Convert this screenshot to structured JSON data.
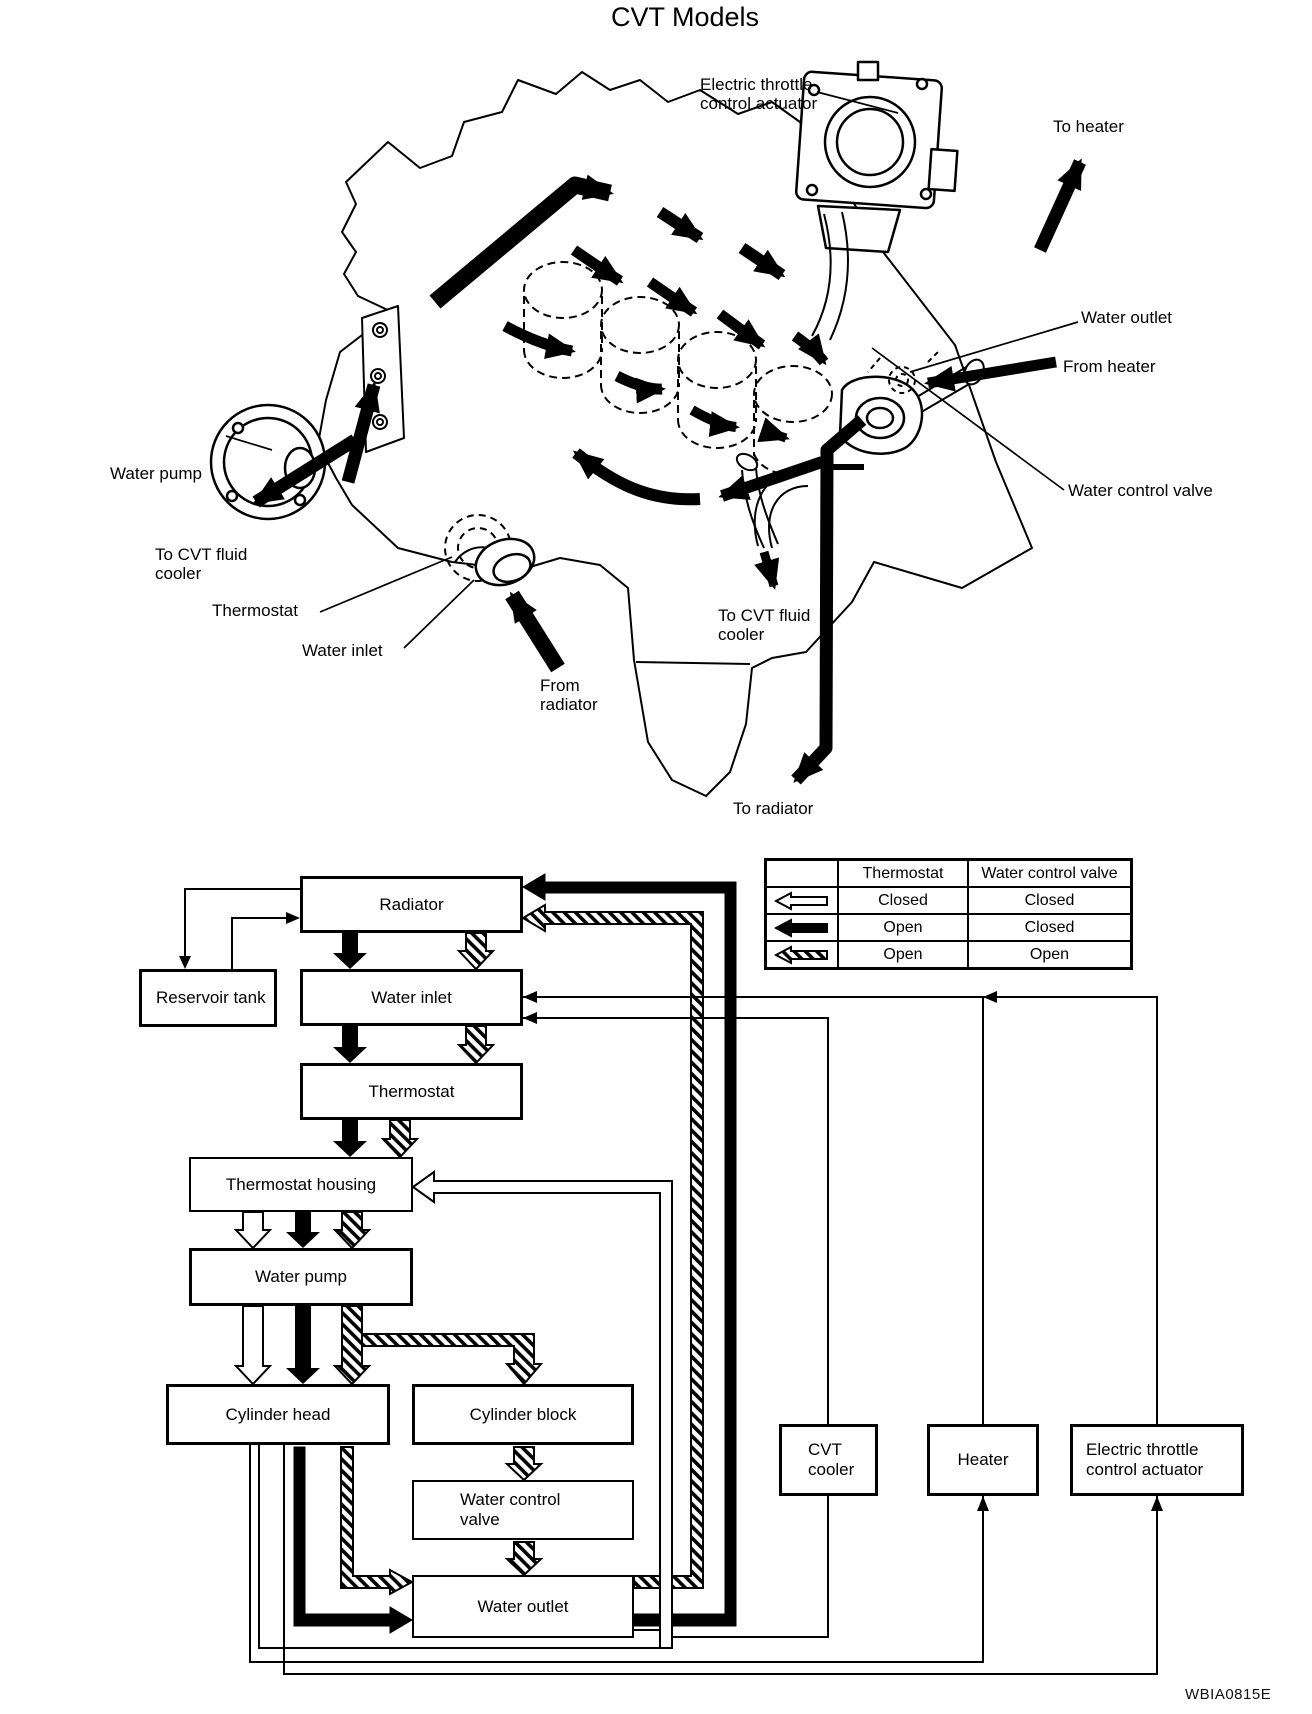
{
  "title": "CVT Models",
  "figure_code": "WBIA0815E",
  "engine_labels": {
    "electric_throttle_control_actuator": "Electric throttle control actuator",
    "to_heater": "To heater",
    "water_outlet": "Water outlet",
    "from_heater": "From heater",
    "water_control_valve": "Water control valve",
    "water_pump": "Water pump",
    "to_cvt_fluid_cooler_left": "To CVT fluid cooler",
    "thermostat": "Thermostat",
    "water_inlet": "Water inlet",
    "from_radiator": "From radiator",
    "to_cvt_fluid_cooler_center": "To CVT fluid cooler",
    "to_radiator": "To radiator"
  },
  "flow_boxes": {
    "radiator": "Radiator",
    "reservoir_tank": "Reservoir tank",
    "water_inlet": "Water inlet",
    "thermostat": "Thermostat",
    "thermostat_housing": "Thermostat housing",
    "water_pump": "Water pump",
    "cylinder_head": "Cylinder head",
    "cylinder_block": "Cylinder block",
    "water_control_valve": "Water control valve",
    "water_outlet": "Water outlet",
    "cvt_cooler": "CVT cooler",
    "heater": "Heater",
    "electric_throttle_control_actuator": "Electric throttle control actuator"
  },
  "legend": {
    "headers": [
      "",
      "Thermostat",
      "Water control valve"
    ],
    "rows": [
      {
        "arrow_style": "open",
        "thermostat": "Closed",
        "water_control_valve": "Closed"
      },
      {
        "arrow_style": "solid",
        "thermostat": "Open",
        "water_control_valve": "Closed"
      },
      {
        "arrow_style": "hatched",
        "thermostat": "Open",
        "water_control_valve": "Open"
      }
    ]
  }
}
